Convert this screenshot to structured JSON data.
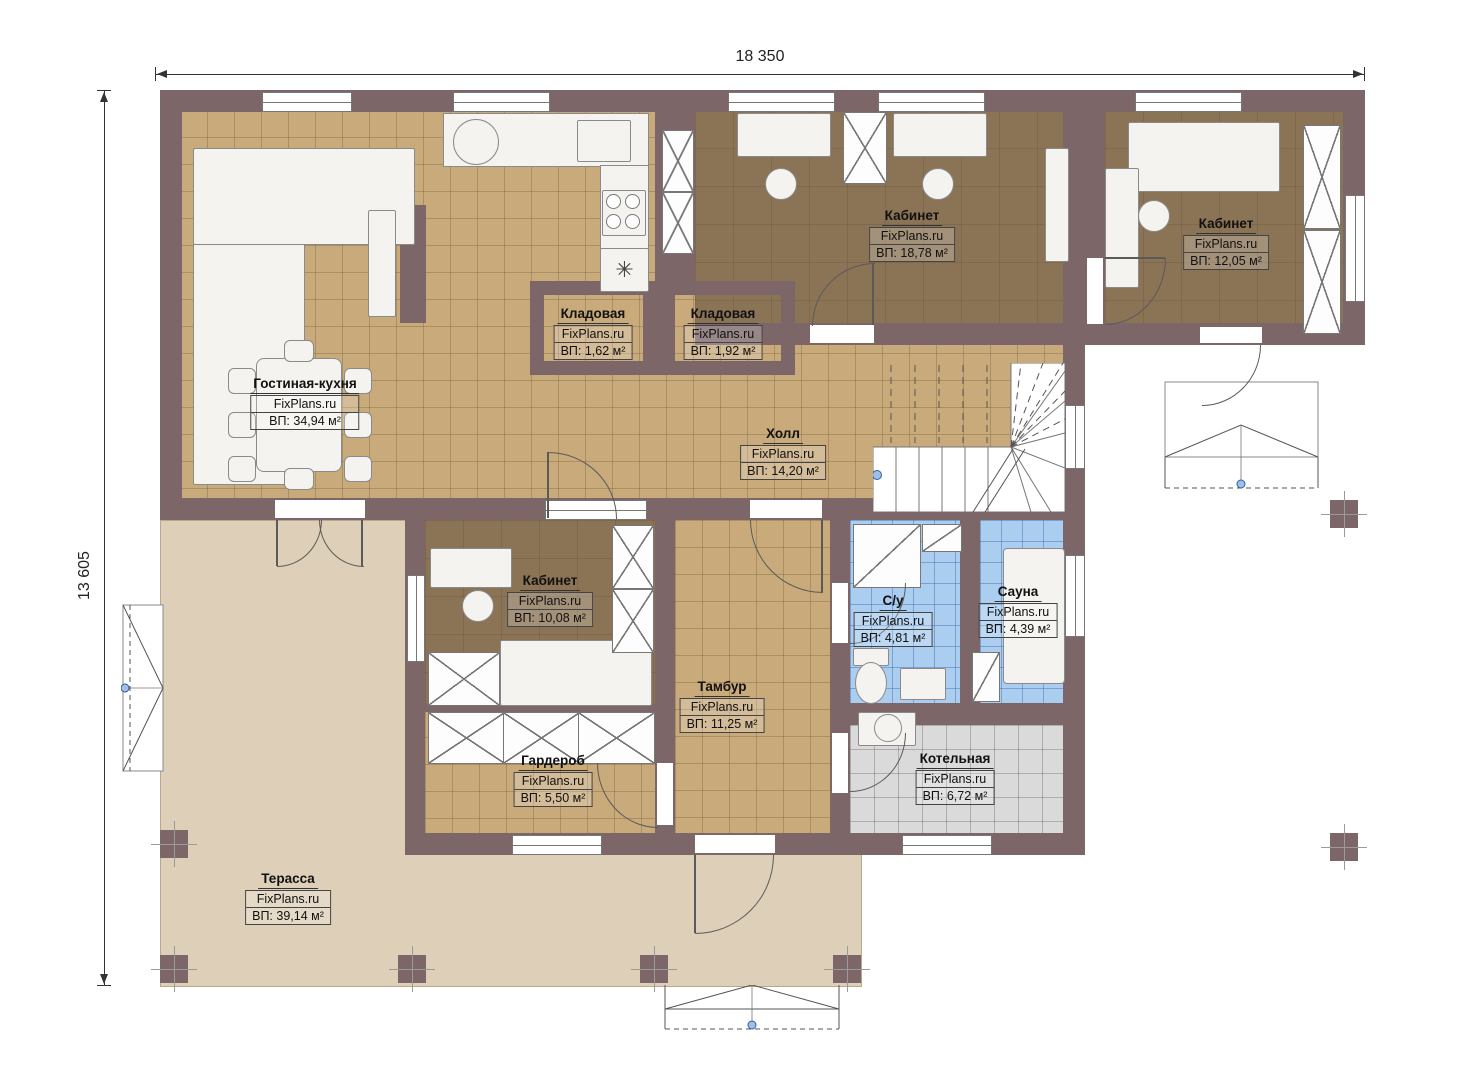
{
  "dimensions": {
    "top": "18 350",
    "left": "13 605"
  },
  "symbols": {
    "vent": "✳"
  },
  "rooms": {
    "living": {
      "name": "Гостиная-кухня",
      "brand": "FixPlans.ru",
      "area": "ВП: 34,94 м²"
    },
    "cabinet_top": {
      "name": "Кабинет",
      "brand": "FixPlans.ru",
      "area": "ВП: 18,78 м²"
    },
    "cabinet_right": {
      "name": "Кабинет",
      "brand": "FixPlans.ru",
      "area": "ВП: 12,05 м²"
    },
    "pantry1": {
      "name": "Кладовая",
      "brand": "FixPlans.ru",
      "area": "ВП: 1,62 м²"
    },
    "pantry2": {
      "name": "Кладовая",
      "brand": "FixPlans.ru",
      "area": "ВП: 1,92 м²"
    },
    "hall": {
      "name": "Холл",
      "brand": "FixPlans.ru",
      "area": "ВП: 14,20 м²"
    },
    "cabinet_mid": {
      "name": "Кабинет",
      "brand": "FixPlans.ru",
      "area": "ВП: 10,08 м²"
    },
    "bathroom": {
      "name": "С/у",
      "brand": "FixPlans.ru",
      "area": "ВП: 4,81 м²"
    },
    "sauna": {
      "name": "Сауна",
      "brand": "FixPlans.ru",
      "area": "ВП: 4,39 м²"
    },
    "vestibule": {
      "name": "Тамбур",
      "brand": "FixPlans.ru",
      "area": "ВП: 11,25 м²"
    },
    "wardrobe": {
      "name": "Гардероб",
      "brand": "FixPlans.ru",
      "area": "ВП: 5,50 м²"
    },
    "boiler": {
      "name": "Котельная",
      "brand": "FixPlans.ru",
      "area": "ВП: 6,72 м²"
    },
    "terrace": {
      "name": "Терасса",
      "brand": "FixPlans.ru",
      "area": "ВП: 39,14 м²"
    }
  },
  "colors": {
    "wall": "#7c6668",
    "tile_tan": "#c9aa7b",
    "floor_dark": "#8b7355",
    "tile_blue": "#aacdf0",
    "tile_gray": "#dadada",
    "terrace": "#ded0b8",
    "marker_blue": "#4a78b8"
  }
}
